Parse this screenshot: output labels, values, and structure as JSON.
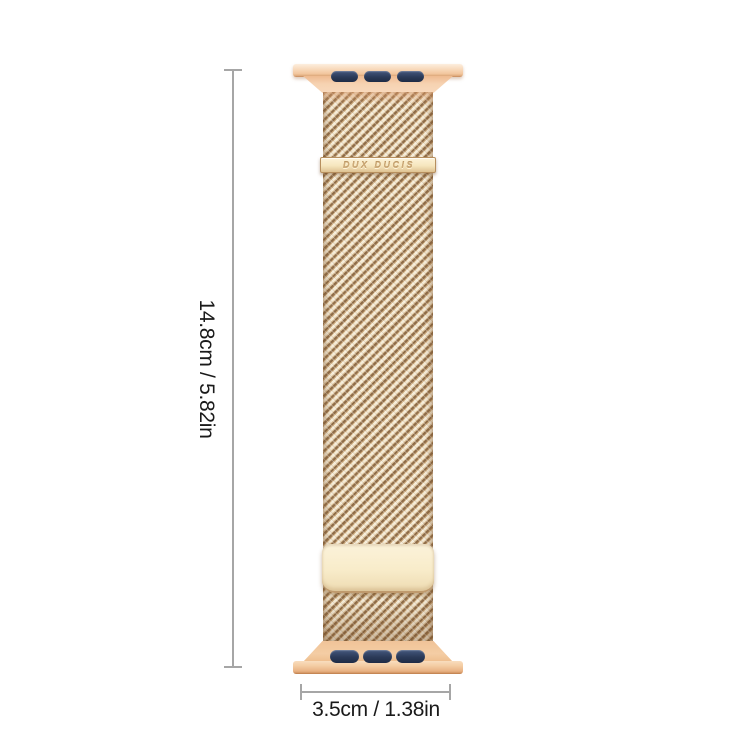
{
  "product": {
    "name": "milanese-loop-watch-band",
    "brand_engraving": "DUX DUCIS",
    "finish": "rose-gold"
  },
  "dimensions": {
    "height_label": "14.8cm / 5.82in",
    "width_label": "3.5cm / 1.38in"
  },
  "colors": {
    "background": "#ffffff",
    "dimension_line_gray": "#a6a6a6",
    "label_text": "#1a1a1a",
    "connector_gold_light": "#f8d9bb",
    "connector_gold_dark": "#c08457",
    "mesh_light": "#f5ebd5",
    "mesh_dark": "#8f6d49",
    "clasp_cream": "#f6e6be",
    "magnet_plate_cream": "#f8ecca",
    "slot_navy": "#2b3a58"
  }
}
